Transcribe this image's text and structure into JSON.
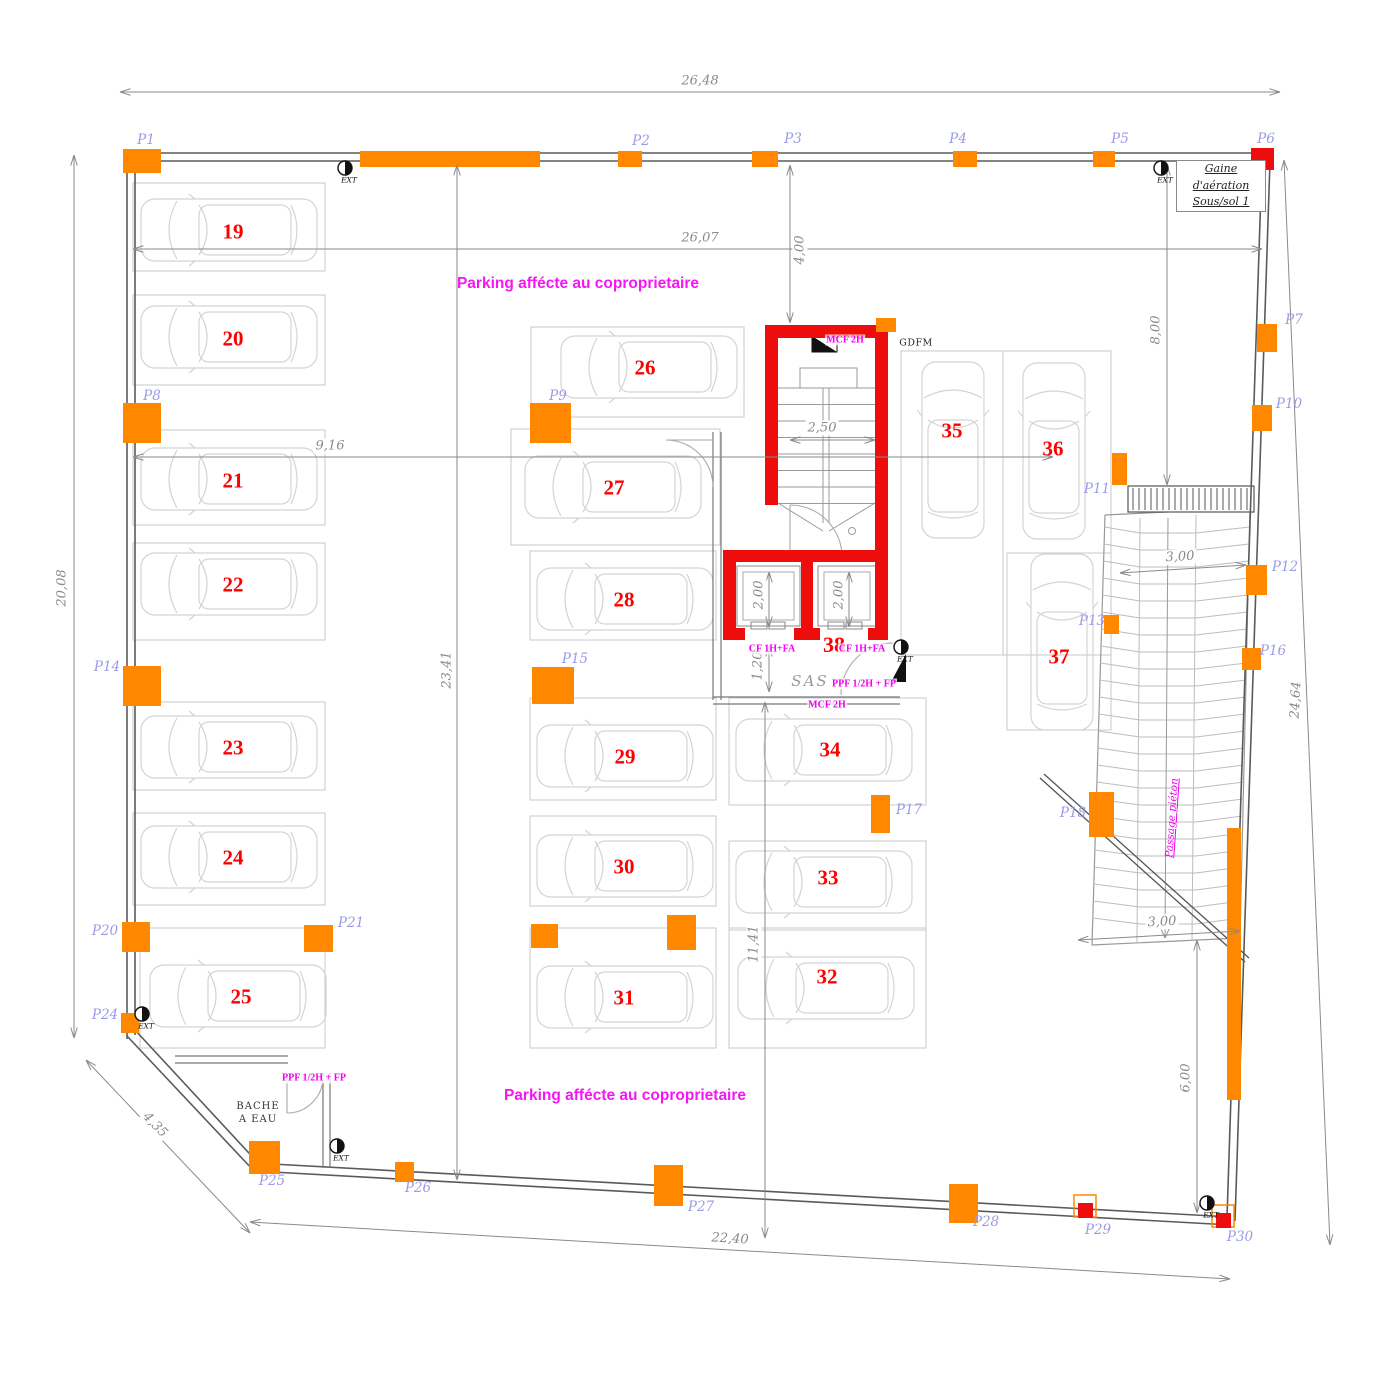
{
  "colors": {
    "pillar_orange": "#FF8800",
    "fire_red": "#EE0D0D",
    "label_magenta": "#F000F0",
    "pillar_label_lavender": "#9A9AE8",
    "dimension_gray": "#8A8A8A",
    "wall_gray": "#5A5A5A",
    "stall_gray": "#C8C8C8",
    "car_gray": "#D4D4D4"
  },
  "zone_titles": [
    {
      "text": "Parking affécte au coproprietaire",
      "x": 578,
      "y": 284
    },
    {
      "text": "Parking affécte au coproprietaire",
      "x": 625,
      "y": 1096
    }
  ],
  "texts": {
    "gaine_line1": "Gaine d'aération",
    "gaine_line2": "Sous/sol 1",
    "gdfm": "GDFM",
    "sas": "SAS",
    "bache_line1": "BACHE",
    "bache_line2": "A EAU",
    "passage_pieton": "Passage piéton",
    "ext": "EXT"
  },
  "fire_labels": [
    {
      "text": "MCF 2H",
      "x": 845,
      "y": 340
    },
    {
      "text": "CF 1H+FA",
      "x": 772,
      "y": 649
    },
    {
      "text": "CF 1H+FA",
      "x": 862,
      "y": 649
    },
    {
      "text": "PPF 1/2H + FP",
      "x": 864,
      "y": 684
    },
    {
      "text": "MCF 2H",
      "x": 827,
      "y": 705
    },
    {
      "text": "PPF 1/2H + FP",
      "x": 314,
      "y": 1078
    }
  ],
  "parking_spaces": [
    {
      "num": "19",
      "stall": [
        133,
        183,
        192,
        88
      ],
      "car": {
        "cx": 229,
        "cy": 230,
        "o": "h"
      },
      "nx": 233,
      "ny": 232
    },
    {
      "num": "20",
      "stall": [
        133,
        295,
        192,
        90
      ],
      "car": {
        "cx": 229,
        "cy": 337,
        "o": "h"
      },
      "nx": 233,
      "ny": 339
    },
    {
      "num": "21",
      "stall": [
        133,
        430,
        192,
        95
      ],
      "car": {
        "cx": 229,
        "cy": 479,
        "o": "h"
      },
      "nx": 233,
      "ny": 481
    },
    {
      "num": "22",
      "stall": [
        133,
        543,
        192,
        97
      ],
      "car": {
        "cx": 229,
        "cy": 584,
        "o": "h"
      },
      "nx": 233,
      "ny": 585
    },
    {
      "num": "23",
      "stall": [
        133,
        702,
        192,
        88
      ],
      "car": {
        "cx": 229,
        "cy": 747,
        "o": "h"
      },
      "nx": 233,
      "ny": 748
    },
    {
      "num": "24",
      "stall": [
        133,
        813,
        192,
        92
      ],
      "car": {
        "cx": 229,
        "cy": 857,
        "o": "h"
      },
      "nx": 233,
      "ny": 858
    },
    {
      "num": "25",
      "stall": [
        140,
        928,
        185,
        120
      ],
      "car": {
        "cx": 238,
        "cy": 996,
        "o": "h"
      },
      "nx": 241,
      "ny": 997
    },
    {
      "num": "26",
      "stall": [
        531,
        327,
        213,
        90
      ],
      "car": {
        "cx": 649,
        "cy": 367,
        "o": "h"
      },
      "nx": 645,
      "ny": 368
    },
    {
      "num": "27",
      "stall": [
        511,
        429,
        209,
        116
      ],
      "car": {
        "cx": 613,
        "cy": 487,
        "o": "h"
      },
      "nx": 614,
      "ny": 488
    },
    {
      "num": "28",
      "stall": [
        530,
        551,
        186,
        89
      ],
      "car": {
        "cx": 625,
        "cy": 599,
        "o": "h"
      },
      "nx": 624,
      "ny": 600
    },
    {
      "num": "29",
      "stall": [
        530,
        698,
        186,
        102
      ],
      "car": {
        "cx": 625,
        "cy": 756,
        "o": "h"
      },
      "nx": 625,
      "ny": 757
    },
    {
      "num": "30",
      "stall": [
        530,
        816,
        186,
        90
      ],
      "car": {
        "cx": 625,
        "cy": 866,
        "o": "h"
      },
      "nx": 624,
      "ny": 867
    },
    {
      "num": "31",
      "stall": [
        530,
        928,
        186,
        120
      ],
      "car": {
        "cx": 625,
        "cy": 997,
        "o": "h"
      },
      "nx": 624,
      "ny": 998
    },
    {
      "num": "32",
      "stall": [
        729,
        928,
        197,
        120
      ],
      "car": {
        "cx": 826,
        "cy": 988,
        "o": "h"
      },
      "nx": 827,
      "ny": 977
    },
    {
      "num": "33",
      "stall": [
        729,
        841,
        197,
        89
      ],
      "car": {
        "cx": 824,
        "cy": 882,
        "o": "h"
      },
      "nx": 828,
      "ny": 878
    },
    {
      "num": "34",
      "stall": [
        729,
        698,
        197,
        107
      ],
      "car": {
        "cx": 824,
        "cy": 750,
        "o": "h"
      },
      "nx": 830,
      "ny": 750
    },
    {
      "num": "35",
      "stall": [
        901,
        351,
        102,
        304
      ],
      "car": {
        "cx": 953,
        "cy": 450,
        "o": "v"
      },
      "nx": 952,
      "ny": 431
    },
    {
      "num": "36",
      "stall": [
        1003,
        351,
        108,
        304
      ],
      "car": {
        "cx": 1054,
        "cy": 451,
        "o": "v"
      },
      "nx": 1053,
      "ny": 449
    },
    {
      "num": "37",
      "stall": [
        1007,
        553,
        104,
        177
      ],
      "car": {
        "cx": 1062,
        "cy": 642,
        "o": "v"
      },
      "nx": 1059,
      "ny": 657
    },
    {
      "num": "38",
      "stall": null,
      "car": null,
      "nx": 834,
      "ny": 645
    }
  ],
  "pillars": [
    {
      "id": "P1",
      "x": 123,
      "y": 149,
      "w": 38,
      "h": 24,
      "c": "o",
      "lx": 146,
      "ly": 140
    },
    {
      "id": "",
      "x": 360,
      "y": 151,
      "w": 180,
      "h": 16,
      "c": "o"
    },
    {
      "id": "P2",
      "x": 618,
      "y": 151,
      "w": 24,
      "h": 16,
      "c": "o",
      "lx": 641,
      "ly": 141
    },
    {
      "id": "P3",
      "x": 752,
      "y": 151,
      "w": 26,
      "h": 16,
      "c": "o",
      "lx": 793,
      "ly": 139
    },
    {
      "id": "P4",
      "x": 953,
      "y": 151,
      "w": 24,
      "h": 16,
      "c": "o",
      "lx": 958,
      "ly": 139
    },
    {
      "id": "P5",
      "x": 1093,
      "y": 151,
      "w": 22,
      "h": 16,
      "c": "o",
      "lx": 1120,
      "ly": 139
    },
    {
      "id": "P6",
      "x": 1251,
      "y": 148,
      "w": 23,
      "h": 22,
      "c": "r",
      "lx": 1266,
      "ly": 139
    },
    {
      "id": "P7",
      "x": 1257,
      "y": 324,
      "w": 20,
      "h": 28,
      "c": "o",
      "lx": 1294,
      "ly": 320
    },
    {
      "id": "P10",
      "x": 1252,
      "y": 405,
      "w": 20,
      "h": 26,
      "c": "o",
      "lx": 1289,
      "ly": 404
    },
    {
      "id": "P12",
      "x": 1246,
      "y": 565,
      "w": 21,
      "h": 30,
      "c": "o",
      "lx": 1285,
      "ly": 567
    },
    {
      "id": "P16",
      "x": 1242,
      "y": 648,
      "w": 19,
      "h": 22,
      "c": "o",
      "lx": 1273,
      "ly": 651
    },
    {
      "id": "P8",
      "x": 123,
      "y": 403,
      "w": 38,
      "h": 40,
      "c": "o",
      "lx": 152,
      "ly": 396
    },
    {
      "id": "P9",
      "x": 530,
      "y": 403,
      "w": 41,
      "h": 40,
      "c": "o",
      "lx": 558,
      "ly": 396
    },
    {
      "id": "P11",
      "x": 1112,
      "y": 453,
      "w": 15,
      "h": 32,
      "c": "o",
      "lx": 1097,
      "ly": 489
    },
    {
      "id": "P13",
      "x": 1104,
      "y": 615,
      "w": 15,
      "h": 19,
      "c": "o",
      "lx": 1092,
      "ly": 621
    },
    {
      "id": "P14",
      "x": 123,
      "y": 666,
      "w": 38,
      "h": 40,
      "c": "o",
      "lx": 107,
      "ly": 667
    },
    {
      "id": "P15",
      "x": 532,
      "y": 667,
      "w": 42,
      "h": 37,
      "c": "o",
      "lx": 575,
      "ly": 659
    },
    {
      "id": "P17",
      "x": 871,
      "y": 795,
      "w": 19,
      "h": 38,
      "c": "o",
      "lx": 909,
      "ly": 810
    },
    {
      "id": "P18",
      "x": 1089,
      "y": 792,
      "w": 25,
      "h": 45,
      "c": "o",
      "lx": 1073,
      "ly": 813
    },
    {
      "id": "P20",
      "x": 122,
      "y": 922,
      "w": 28,
      "h": 30,
      "c": "o",
      "lx": 105,
      "ly": 931
    },
    {
      "id": "P21",
      "x": 304,
      "y": 925,
      "w": 29,
      "h": 27,
      "c": "o",
      "lx": 351,
      "ly": 923
    },
    {
      "id": "P24",
      "x": 121,
      "y": 1013,
      "w": 18,
      "h": 20,
      "c": "o",
      "lx": 105,
      "ly": 1015
    },
    {
      "id": "P25",
      "x": 249,
      "y": 1141,
      "w": 31,
      "h": 33,
      "c": "o",
      "lx": 272,
      "ly": 1181
    },
    {
      "id": "P26",
      "x": 395,
      "y": 1162,
      "w": 19,
      "h": 20,
      "c": "o",
      "lx": 418,
      "ly": 1188
    },
    {
      "id": "P27",
      "x": 654,
      "y": 1165,
      "w": 29,
      "h": 41,
      "c": "o",
      "lx": 701,
      "ly": 1207
    },
    {
      "id": "P28",
      "x": 949,
      "y": 1184,
      "w": 29,
      "h": 39,
      "c": "o",
      "lx": 986,
      "ly": 1222
    },
    {
      "id": "P29",
      "x": 1078,
      "y": 1203,
      "w": 15,
      "h": 15,
      "c": "rb",
      "lx": 1098,
      "ly": 1230
    },
    {
      "id": "P30",
      "x": 1216,
      "y": 1213,
      "w": 15,
      "h": 15,
      "c": "rb",
      "lx": 1240,
      "ly": 1237
    },
    {
      "id": "",
      "x": 1227,
      "y": 828,
      "w": 14,
      "h": 272,
      "c": "o"
    },
    {
      "id": "",
      "x": 531,
      "y": 924,
      "w": 27,
      "h": 24,
      "c": "o"
    },
    {
      "id": "",
      "x": 667,
      "y": 915,
      "w": 29,
      "h": 35,
      "c": "o"
    },
    {
      "id": "",
      "x": 876,
      "y": 318,
      "w": 20,
      "h": 14,
      "c": "o"
    }
  ],
  "dimensions": [
    {
      "label": "26,48",
      "x1": 120,
      "y1": 92,
      "x2": 1280,
      "y2": 92,
      "lx": 700,
      "ly": 81,
      "rot": 0
    },
    {
      "label": "26,07",
      "x1": 133,
      "y1": 249,
      "x2": 1262,
      "y2": 249,
      "lx": 700,
      "ly": 238,
      "rot": 0
    },
    {
      "label": "20,08",
      "x1": 74,
      "y1": 155,
      "x2": 74,
      "y2": 1038,
      "lx": 62,
      "ly": 588,
      "rot": -90
    },
    {
      "label": "9,16",
      "x1": 133,
      "y1": 457,
      "x2": 1053,
      "y2": 457,
      "lx": 330,
      "ly": 446,
      "rot": 0
    },
    {
      "label": "23,41",
      "x1": 457,
      "y1": 165,
      "x2": 457,
      "y2": 1180,
      "lx": 447,
      "ly": 670,
      "rot": -90
    },
    {
      "label": "4,00",
      "x1": 790,
      "y1": 165,
      "x2": 790,
      "y2": 323,
      "lx": 800,
      "ly": 250,
      "rot": -90
    },
    {
      "label": "8,00",
      "x1": 1167,
      "y1": 165,
      "x2": 1167,
      "y2": 485,
      "lx": 1156,
      "ly": 330,
      "rot": -90
    },
    {
      "label": "11,41",
      "x1": 765,
      "y1": 702,
      "x2": 765,
      "y2": 1238,
      "lx": 754,
      "ly": 944,
      "rot": -90
    },
    {
      "label": "24,64",
      "x1": 1284,
      "y1": 160,
      "x2": 1330,
      "y2": 1245,
      "lx": 1296,
      "ly": 700,
      "rot": -87
    },
    {
      "label": "6,00",
      "x1": 1197,
      "y1": 940,
      "x2": 1197,
      "y2": 1213,
      "lx": 1186,
      "ly": 1078,
      "rot": -90
    },
    {
      "label": "22,40",
      "x1": 250,
      "y1": 1222,
      "x2": 1230,
      "y2": 1279,
      "lx": 730,
      "ly": 1239,
      "rot": 3.3
    },
    {
      "label": "4,35",
      "x1": 86,
      "y1": 1060,
      "x2": 250,
      "y2": 1233,
      "lx": 155,
      "ly": 1125,
      "rot": 46
    },
    {
      "label": "3,00",
      "x1": 1120,
      "y1": 573,
      "x2": 1246,
      "y2": 565,
      "lx": 1180,
      "ly": 557,
      "rot": -3
    },
    {
      "label": "3,00",
      "x1": 1078,
      "y1": 940,
      "x2": 1240,
      "y2": 931,
      "lx": 1162,
      "ly": 922,
      "rot": -3
    },
    {
      "label": "2,50",
      "x1": 790,
      "y1": 440,
      "x2": 875,
      "y2": 440,
      "lx": 822,
      "ly": 428,
      "rot": 0
    },
    {
      "label": "2,00",
      "x1": 769,
      "y1": 572,
      "x2": 769,
      "y2": 627,
      "lx": 759,
      "ly": 595,
      "rot": -90
    },
    {
      "label": "2,00",
      "x1": 849,
      "y1": 572,
      "x2": 849,
      "y2": 627,
      "lx": 839,
      "ly": 595,
      "rot": -90
    },
    {
      "label": "1,20",
      "x1": 769,
      "y1": 646,
      "x2": 769,
      "y2": 692,
      "lx": 758,
      "ly": 666,
      "rot": -90
    }
  ],
  "ext_markers": [
    {
      "x": 345,
      "y": 168
    },
    {
      "x": 1161,
      "y": 168
    },
    {
      "x": 142,
      "y": 1014
    },
    {
      "x": 337,
      "y": 1146
    },
    {
      "x": 901,
      "y": 647
    },
    {
      "x": 1207,
      "y": 1203
    }
  ]
}
